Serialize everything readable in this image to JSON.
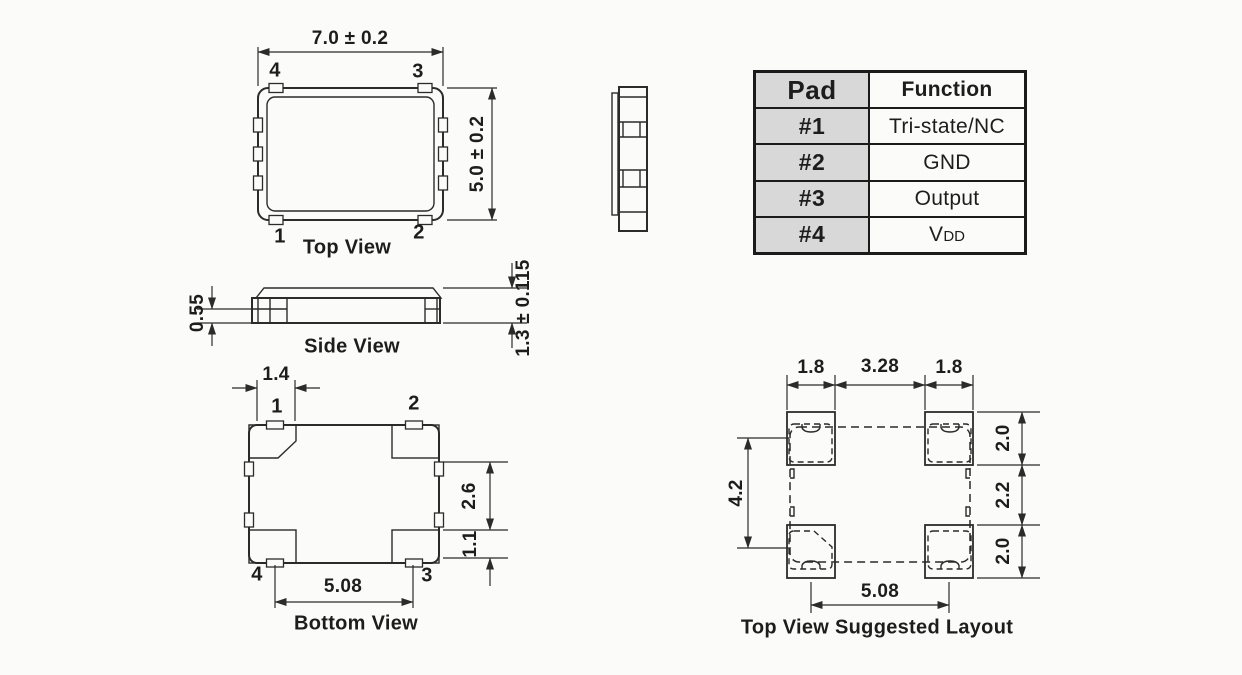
{
  "top_view": {
    "title": "Top View",
    "dim_width": "7.0 ± 0.2",
    "dim_height": "5.0 ± 0.2",
    "pad_top_left": "4",
    "pad_top_right": "3",
    "pad_bottom_left": "1",
    "pad_bottom_right": "2"
  },
  "side_view": {
    "title": "Side View",
    "dim_pad_height": "0.55",
    "dim_body_height": "1.3 ± 0.115"
  },
  "bottom_view": {
    "title": "Bottom View",
    "dim_pad_width": "1.4",
    "dim_pad_length": "2.6",
    "dim_edge_gap": "1.1",
    "dim_pad_pitch": "5.08",
    "pad_top_left": "1",
    "pad_top_right": "2",
    "pad_bottom_left": "4",
    "pad_bottom_right": "3"
  },
  "suggested_layout": {
    "title": "Top View Suggested Layout",
    "dim_left_pad_width": "1.8",
    "dim_center_gap": "3.28",
    "dim_right_pad_width": "1.8",
    "dim_vertical_span": "4.2",
    "dim_top_pad_height": "2.0",
    "dim_middle_gap": "2.2",
    "dim_bottom_pad_height": "2.0",
    "dim_pad_pitch": "5.08"
  },
  "pad_table": {
    "header_pad": "Pad",
    "header_function": "Function",
    "rows": [
      {
        "pad": "#1",
        "function": "Tri-state/NC"
      },
      {
        "pad": "#2",
        "function": "GND"
      },
      {
        "pad": "#3",
        "function": "Output"
      },
      {
        "pad": "#4",
        "function": "V",
        "function_sub": "DD"
      }
    ]
  }
}
